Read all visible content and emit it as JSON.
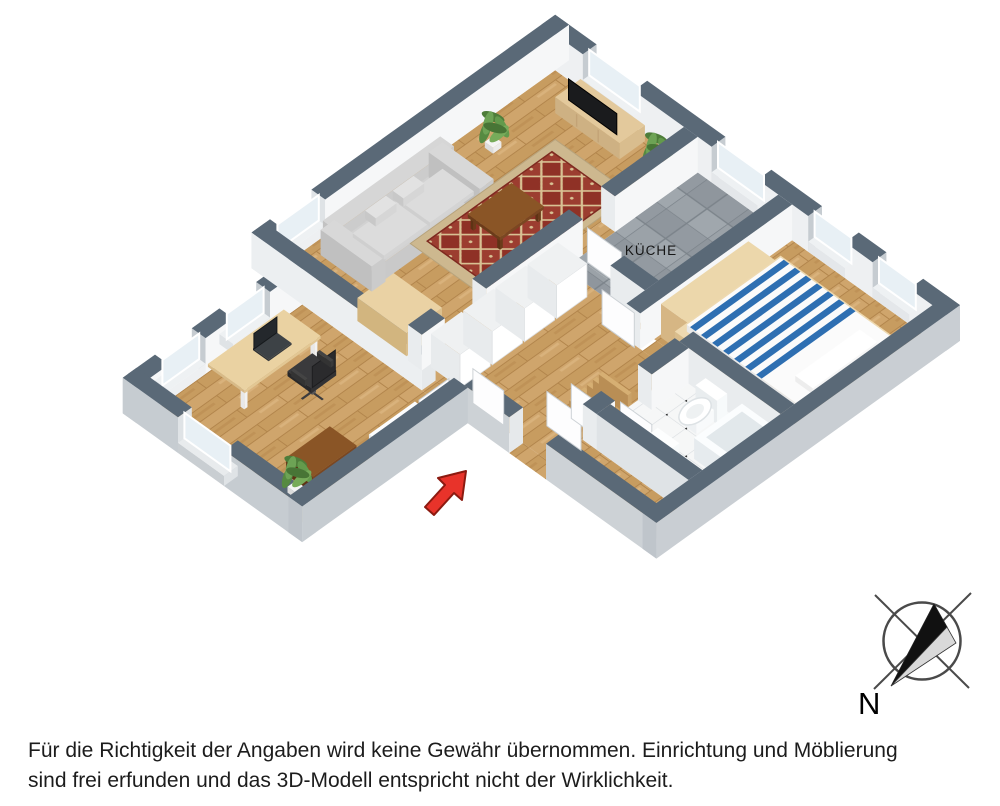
{
  "floorplan": {
    "kitchen_label": "KÜCHE",
    "compass": {
      "label": "N"
    },
    "disclaimer": {
      "line1": "Für die Richtigkeit der Angaben wird keine Gewähr übernommen. Einrichtung und Möblierung",
      "line2": "sind frei erfunden und das 3D-Modell entspricht nicht der Wirklichkeit."
    },
    "colors": {
      "wall_top": "#5a6977",
      "wall_side_bright": "#f6f7f8",
      "wall_side_shade": "#e9ecee",
      "wall_outer": "#c6ccd1",
      "wall_cap": "#dfe3e6",
      "wood_floor": "#cfa56c",
      "wood_floor_dark": "#b2854c",
      "kitchen_tile": "#99a0a6",
      "bath_tile": "#f6f7f7",
      "rug_red": "#8f3126",
      "rug_trim": "#d8c193",
      "rug_border": "#cdb88f",
      "sofa_gray": "#cccccc",
      "bed_blue": "#2e6fb2",
      "wood_light": "#e3c795",
      "wood_mid": "#caa268",
      "wood_dark": "#7a4722",
      "tv_black": "#1a1b1d",
      "plant_green": "#5c8f45",
      "glass": "#e8f0f5",
      "arrow_red": "#e8332a",
      "arrow_outline": "#8c1a10",
      "compass_stroke": "#4a4a4a",
      "compass_gray": "#d9d9d9",
      "text": "#1c1c1c"
    }
  }
}
